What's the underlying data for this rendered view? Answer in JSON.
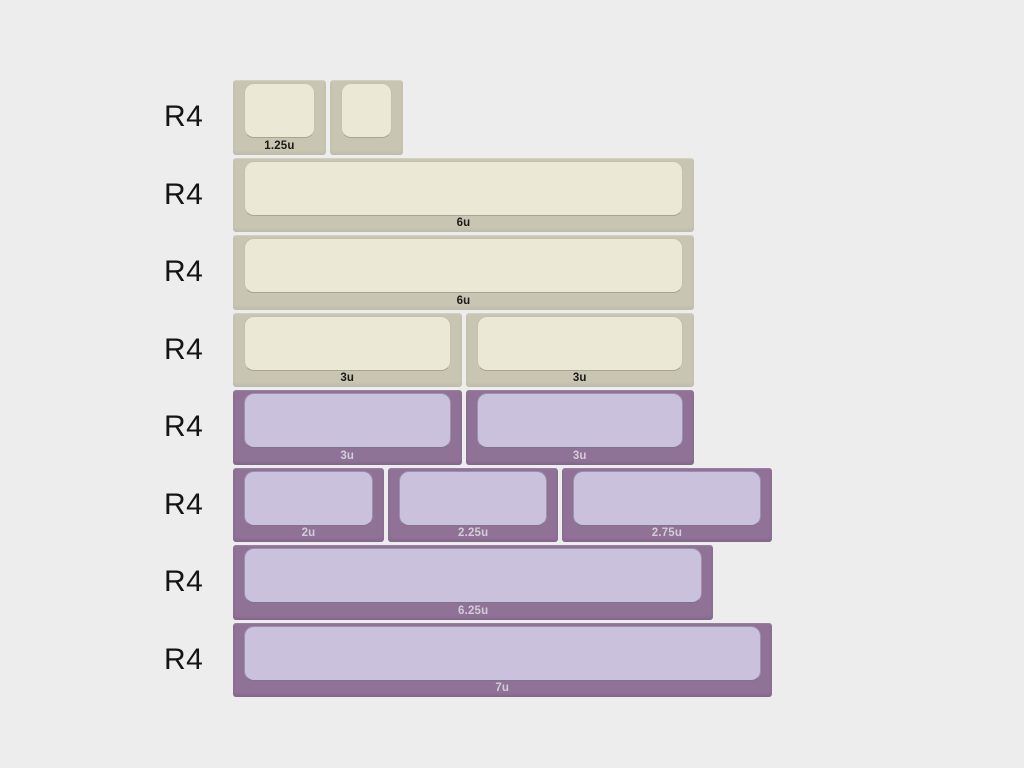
{
  "colors": {
    "background": "#eeedee",
    "beige_base": "#c8c5b2",
    "beige_top": "#ebe8d5",
    "beige_label_text": "#1b1b19",
    "purple_base": "#8f7296",
    "purple_top": "#cac2dd",
    "purple_label_text": "#d2cdd9",
    "row_label_text": "#141414"
  },
  "rows": [
    {
      "row_label": "R4",
      "colorway": "beige",
      "keys": [
        {
          "size_u": 1.25,
          "size_label": "1.25u"
        },
        {
          "size_u": 1,
          "size_label": ""
        }
      ]
    },
    {
      "row_label": "R4",
      "colorway": "beige",
      "keys": [
        {
          "size_u": 6,
          "size_label": "6u"
        }
      ]
    },
    {
      "row_label": "R4",
      "colorway": "beige",
      "keys": [
        {
          "size_u": 6,
          "size_label": "6u"
        }
      ]
    },
    {
      "row_label": "R4",
      "colorway": "beige",
      "keys": [
        {
          "size_u": 3,
          "size_label": "3u"
        },
        {
          "size_u": 3,
          "size_label": "3u"
        }
      ]
    },
    {
      "row_label": "R4",
      "colorway": "purple",
      "keys": [
        {
          "size_u": 3,
          "size_label": "3u"
        },
        {
          "size_u": 3,
          "size_label": "3u"
        }
      ]
    },
    {
      "row_label": "R4",
      "colorway": "purple",
      "keys": [
        {
          "size_u": 2,
          "size_label": "2u"
        },
        {
          "size_u": 2.25,
          "size_label": "2.25u"
        },
        {
          "size_u": 2.75,
          "size_label": "2.75u"
        }
      ]
    },
    {
      "row_label": "R4",
      "colorway": "purple",
      "keys": [
        {
          "size_u": 6.25,
          "size_label": "6.25u"
        }
      ]
    },
    {
      "row_label": "R4",
      "colorway": "purple",
      "keys": [
        {
          "size_u": 7,
          "size_label": "7u"
        }
      ]
    }
  ]
}
